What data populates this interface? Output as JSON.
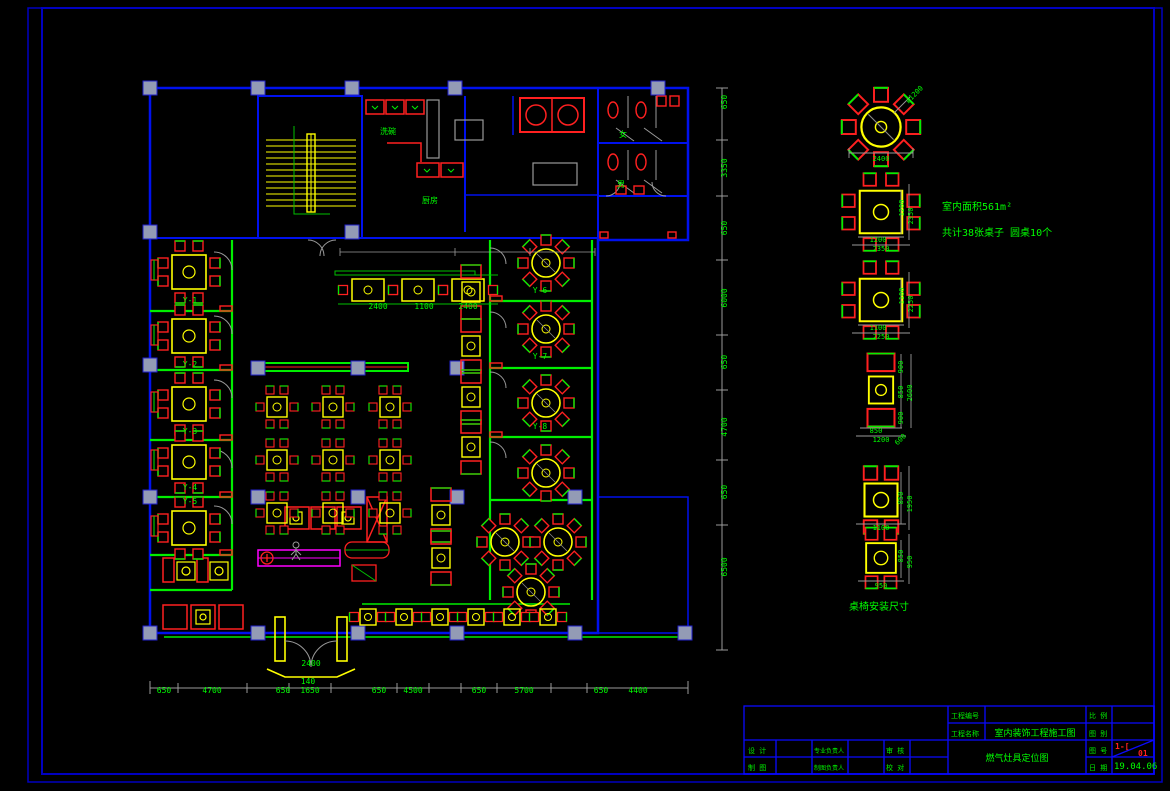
{
  "colors": {
    "wall": "#0011ee",
    "frame": "#0000c0",
    "partition": "#00ff00",
    "table": "#ffff00",
    "chair": "#ff0000",
    "dim_text": "#00ff00",
    "counter": "#ff00ff",
    "column": "#939bb5",
    "door_arc": "#9a9a9a",
    "stamp_red": "#ff2020"
  },
  "notes": {
    "area_line1": "室内面积561m²",
    "area_line2": "共计38张桌子  圆桌10个",
    "legend_title": "桌椅安装尺寸"
  },
  "plan": {
    "labels": [
      {
        "x": 388,
        "y": 134,
        "t": "洗碗"
      },
      {
        "x": 430,
        "y": 203,
        "t": "厨房"
      },
      {
        "x": 623,
        "y": 137,
        "t": "女"
      },
      {
        "x": 621,
        "y": 187,
        "t": "男"
      },
      {
        "x": 190,
        "y": 303,
        "t": "Y-1"
      },
      {
        "x": 190,
        "y": 367,
        "t": "Y-2"
      },
      {
        "x": 190,
        "y": 434,
        "t": "Y-3"
      },
      {
        "x": 190,
        "y": 490,
        "t": "Y-4"
      },
      {
        "x": 190,
        "y": 504,
        "t": "Y-5"
      },
      {
        "x": 540,
        "y": 293,
        "t": "Y-6"
      },
      {
        "x": 540,
        "y": 359,
        "t": "Y-7"
      },
      {
        "x": 540,
        "y": 429,
        "t": "Y-8"
      },
      {
        "x": 311,
        "y": 666,
        "t": "2400"
      },
      {
        "x": 308,
        "y": 684,
        "t": "140"
      },
      {
        "x": 378,
        "y": 309,
        "t": "2400"
      },
      {
        "x": 424,
        "y": 309,
        "t": "1100"
      },
      {
        "x": 468,
        "y": 309,
        "t": "2400"
      }
    ],
    "bottom_dims": [
      {
        "x": 164,
        "y": 693,
        "t": "650"
      },
      {
        "x": 212,
        "y": 693,
        "t": "4700"
      },
      {
        "x": 283,
        "y": 693,
        "t": "650"
      },
      {
        "x": 310,
        "y": 693,
        "t": "1650"
      },
      {
        "x": 379,
        "y": 693,
        "t": "650"
      },
      {
        "x": 413,
        "y": 693,
        "t": "4500"
      },
      {
        "x": 479,
        "y": 693,
        "t": "650"
      },
      {
        "x": 524,
        "y": 693,
        "t": "5700"
      },
      {
        "x": 601,
        "y": 693,
        "t": "650"
      },
      {
        "x": 638,
        "y": 693,
        "t": "4400"
      }
    ],
    "right_dims": [
      {
        "x": 727,
        "y": 102,
        "t": "650",
        "r": -90
      },
      {
        "x": 727,
        "y": 168,
        "t": "3350",
        "r": -90
      },
      {
        "x": 727,
        "y": 228,
        "t": "650",
        "r": -90
      },
      {
        "x": 727,
        "y": 298,
        "t": "6000",
        "r": -90
      },
      {
        "x": 727,
        "y": 362,
        "t": "650",
        "r": -90
      },
      {
        "x": 727,
        "y": 427,
        "t": "4700",
        "r": -90
      },
      {
        "x": 727,
        "y": 492,
        "t": "650",
        "r": -90
      },
      {
        "x": 727,
        "y": 567,
        "t": "6500",
        "r": -90
      }
    ],
    "columns": [
      [
        150,
        88
      ],
      [
        258,
        88
      ],
      [
        352,
        88
      ],
      [
        455,
        88
      ],
      [
        658,
        88
      ],
      [
        150,
        232
      ],
      [
        352,
        232
      ],
      [
        150,
        365
      ],
      [
        258,
        368
      ],
      [
        358,
        368
      ],
      [
        457,
        368
      ],
      [
        150,
        497
      ],
      [
        258,
        497
      ],
      [
        358,
        497
      ],
      [
        457,
        497
      ],
      [
        575,
        497
      ],
      [
        150,
        633
      ],
      [
        258,
        633
      ],
      [
        358,
        633
      ],
      [
        457,
        633
      ],
      [
        575,
        633
      ],
      [
        685,
        633
      ]
    ],
    "t8": [
      [
        189,
        272
      ],
      [
        189,
        336
      ],
      [
        189,
        404
      ],
      [
        189,
        462
      ],
      [
        189,
        528
      ]
    ],
    "t4": [
      [
        277,
        407
      ],
      [
        333,
        407
      ],
      [
        390,
        407
      ],
      [
        277,
        460
      ],
      [
        333,
        460
      ],
      [
        390,
        460
      ],
      [
        277,
        513
      ],
      [
        333,
        513
      ],
      [
        390,
        513
      ]
    ],
    "tlong": [
      [
        368,
        290
      ],
      [
        418,
        290
      ],
      [
        468,
        290
      ]
    ],
    "r8": [
      [
        546,
        263
      ],
      [
        546,
        329
      ],
      [
        546,
        403
      ],
      [
        546,
        473
      ],
      [
        505,
        542
      ],
      [
        558,
        542
      ],
      [
        531,
        592
      ]
    ],
    "boothv": [
      [
        471,
        292
      ],
      [
        471,
        346
      ],
      [
        471,
        397
      ],
      [
        471,
        447
      ],
      [
        441,
        515
      ],
      [
        441,
        558
      ]
    ],
    "boothh": [
      [
        368,
        617
      ],
      [
        404,
        617
      ],
      [
        440,
        617
      ],
      [
        476,
        617
      ],
      [
        512,
        617
      ],
      [
        548,
        617
      ]
    ],
    "winL": [
      [
        150,
        270
      ],
      [
        150,
        335
      ],
      [
        150,
        402
      ],
      [
        150,
        460
      ],
      [
        150,
        526
      ]
    ]
  },
  "legend": {
    "r8": [
      [
        881,
        127,
        0,
        1.4
      ]
    ],
    "t8": [
      [
        881,
        212,
        0,
        1.25
      ],
      [
        881,
        300,
        0,
        1.25
      ]
    ],
    "booth": [
      [
        881,
        390,
        0,
        1.35
      ]
    ],
    "t4v": [
      [
        881,
        500,
        0,
        1.5
      ],
      [
        881,
        558,
        0,
        1.35
      ]
    ],
    "dims": [
      {
        "x": 916,
        "y": 96,
        "t": "ø1200",
        "r": -45
      },
      {
        "x": 881,
        "y": 161,
        "t": "2400"
      },
      {
        "x": 904,
        "y": 208,
        "t": "1200",
        "r": -90
      },
      {
        "x": 913,
        "y": 216,
        "t": "2350",
        "r": -90
      },
      {
        "x": 878,
        "y": 242,
        "t": "1200"
      },
      {
        "x": 881,
        "y": 251,
        "t": "2350"
      },
      {
        "x": 904,
        "y": 296,
        "t": "1100",
        "r": -90
      },
      {
        "x": 913,
        "y": 304,
        "t": "2250",
        "r": -90
      },
      {
        "x": 878,
        "y": 330,
        "t": "1100"
      },
      {
        "x": 881,
        "y": 339,
        "t": "2250"
      },
      {
        "x": 903,
        "y": 367,
        "t": "900",
        "r": -90
      },
      {
        "x": 903,
        "y": 392,
        "t": "850",
        "r": -90
      },
      {
        "x": 903,
        "y": 418,
        "t": "900",
        "r": -90
      },
      {
        "x": 912,
        "y": 393,
        "t": "2600",
        "r": -90
      },
      {
        "x": 876,
        "y": 433,
        "t": "850"
      },
      {
        "x": 881,
        "y": 442,
        "t": "1200"
      },
      {
        "x": 902,
        "y": 441,
        "t": "600",
        "r": -45
      },
      {
        "x": 903,
        "y": 498,
        "t": "850",
        "r": -90
      },
      {
        "x": 912,
        "y": 504,
        "t": "1950",
        "r": -90
      },
      {
        "x": 881,
        "y": 530,
        "t": "1100"
      },
      {
        "x": 903,
        "y": 556,
        "t": "850",
        "r": -90
      },
      {
        "x": 912,
        "y": 562,
        "t": "950",
        "r": -90
      },
      {
        "x": 881,
        "y": 588,
        "t": "950"
      }
    ]
  },
  "titleblock": {
    "project_no_label": "工程编号",
    "project_name_label": "工程名称",
    "project_name": "室内装饰工程施工图",
    "scale_label": "比 例",
    "type_label": "图 别",
    "no_label": "图 号",
    "date_label": "日 期",
    "r1c1": "设 计",
    "r1c2": "专业负责人",
    "r1c3": "审 核",
    "r2c1": "制 图",
    "r2c2": "制图负责人",
    "r2c3": "校 对",
    "drawing_title": "燃气灶具定位图",
    "sheet_no": "1-[",
    "sheet_no2": "01",
    "date_value": "19.04.06"
  }
}
